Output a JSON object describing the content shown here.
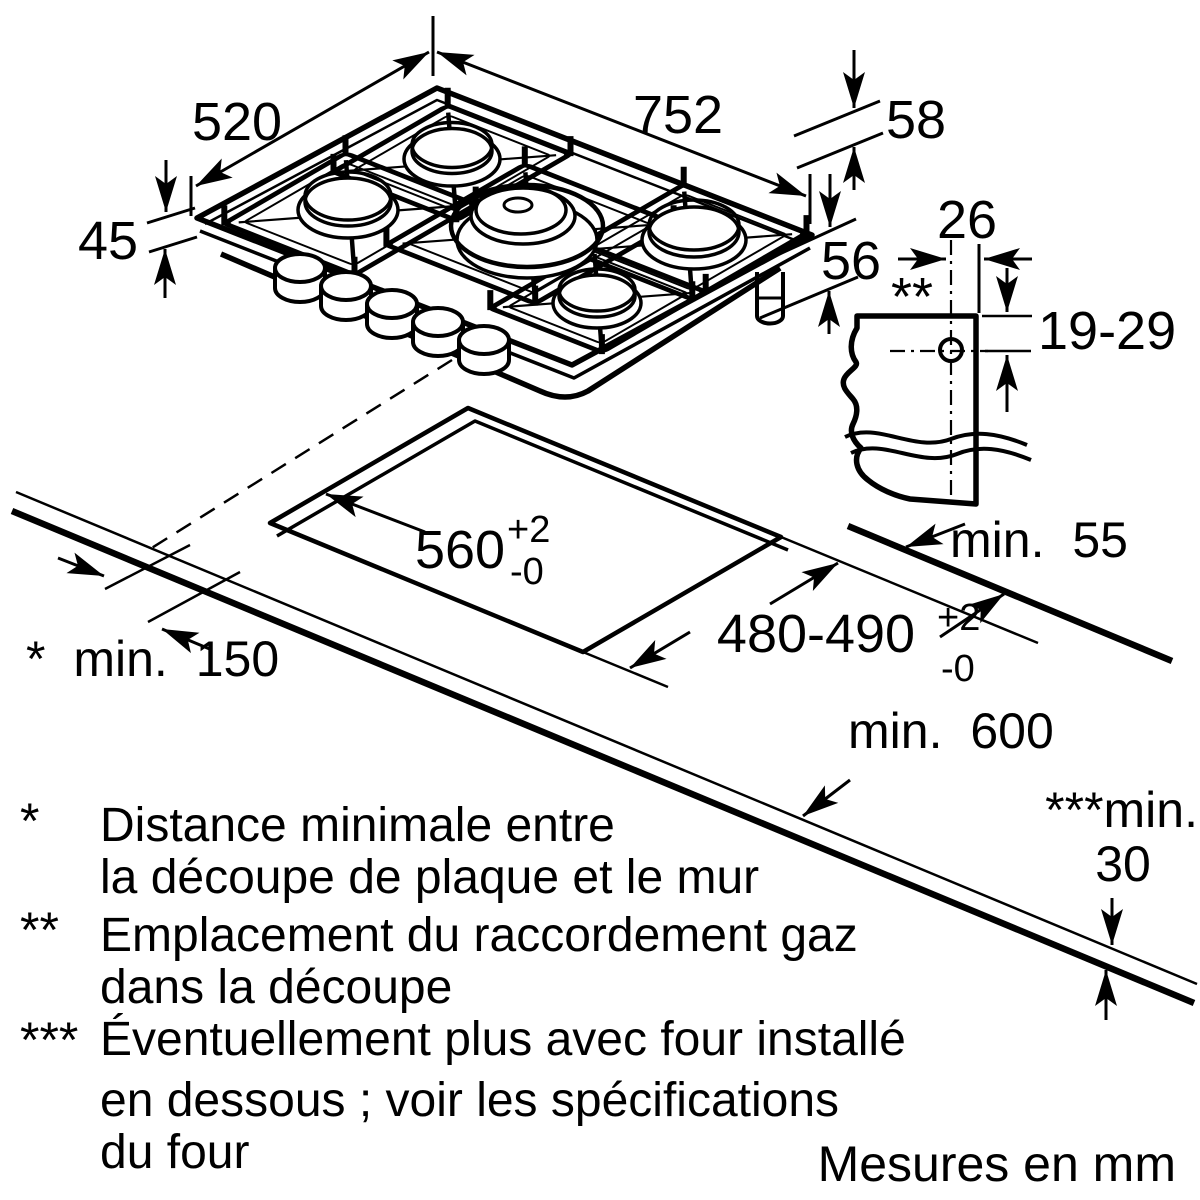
{
  "labels": {
    "d520": "520",
    "d752": "752",
    "d45": "45",
    "d58": "58",
    "d56": "56",
    "d26": "26",
    "star2": "**",
    "d1929": "19-29",
    "min55": "min. 55",
    "d560": "560",
    "d560p": "+2",
    "d560m": "-0",
    "d480": "480-490",
    "d480p": "+2",
    "d480m": "-0",
    "min150": "* min. 150",
    "min600": "min. 600",
    "min30a": "***min.",
    "min30b": "30"
  },
  "legend": [
    {
      "marker": "*",
      "lines": [
        "Distance minimale entre",
        "la découpe de plaque et le mur"
      ]
    },
    {
      "marker": "**",
      "lines": [
        "Emplacement du raccordement gaz",
        "dans la découpe"
      ]
    },
    {
      "marker": "***",
      "lines": [
        "Éventuellement plus avec four installé",
        "en dessous ; voir les spécifications",
        "du four"
      ]
    }
  ],
  "footer": "Mesures en mm",
  "colors": {
    "line": "#000000",
    "burner_cap": "#c6c6c6",
    "background": "#ffffff"
  }
}
